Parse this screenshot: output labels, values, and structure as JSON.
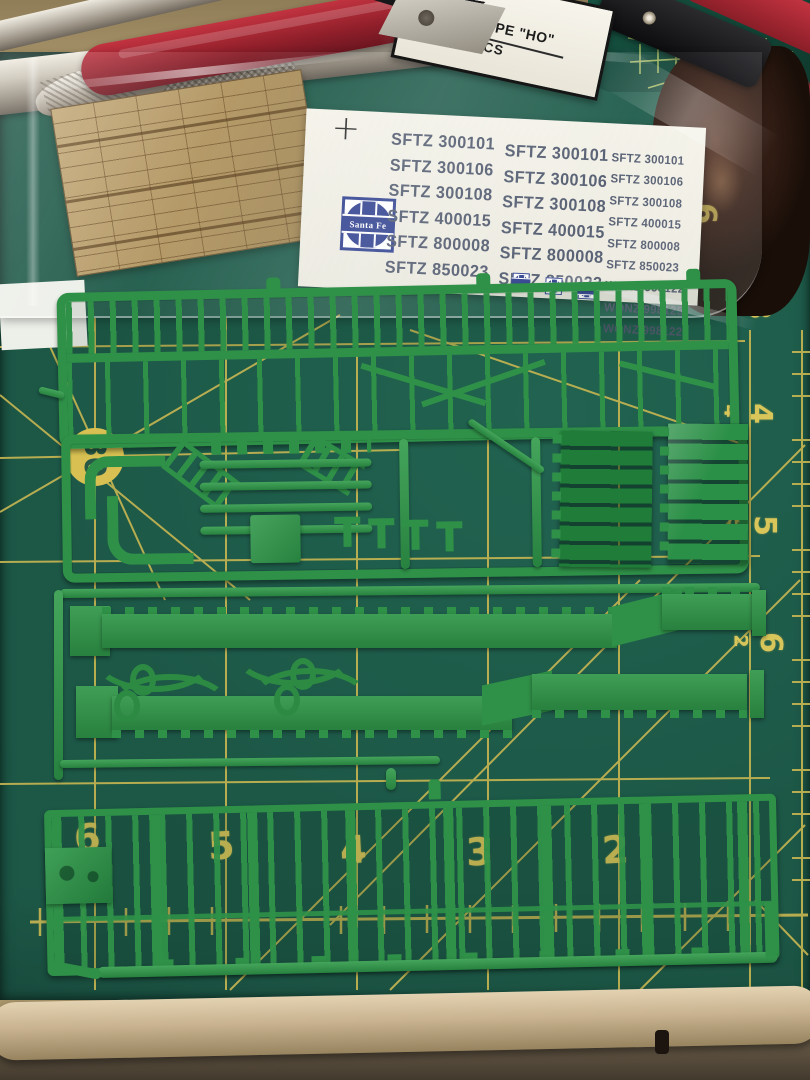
{
  "package_label": {
    "line1": "DROP TYPE \"HO\"",
    "line2": "X.  100 PCS"
  },
  "decal_sheet": {
    "registration_mark": "+",
    "logo_text": "Santa Fe",
    "column1": [
      "SFTZ 300101",
      "SFTZ 300106",
      "SFTZ 300108",
      "SFTZ 400015",
      "SFTZ 800008",
      "SFTZ 850023"
    ],
    "column2": [
      "SFTZ 300101",
      "SFTZ 300106",
      "SFTZ 300108",
      "SFTZ 400015",
      "SFTZ 800008",
      "SFTZ 850023"
    ],
    "column3": [
      "SFTZ 300101",
      "SFTZ 300106",
      "SFTZ 300108",
      "SFTZ 400015",
      "SFTZ 800008",
      "SFTZ 850023",
      "WONZ 998122",
      "WONZ 998125",
      "WONZ 998122"
    ]
  },
  "cutting_mat": {
    "angle_label": "30",
    "bottom_scale": [
      "6",
      "5",
      "4",
      "3",
      "2"
    ],
    "right_scale": [
      {
        "inner": "5",
        "outer": "3"
      },
      {
        "inner": "4",
        "outer": "4"
      },
      {
        "inner": "5",
        "outer": "5"
      },
      {
        "inner": "2",
        "outer": "6"
      }
    ],
    "hidden_number": "6",
    "colors": {
      "mat_green": "#1d5847",
      "grid_yellow": "#d4c156",
      "sprue_green": "#2f9148",
      "decal_blue": "#2e3f8e",
      "decal_text": "#515a6e",
      "wood_tan": "#b0945f",
      "handle_red": "#8f1f2a"
    }
  }
}
